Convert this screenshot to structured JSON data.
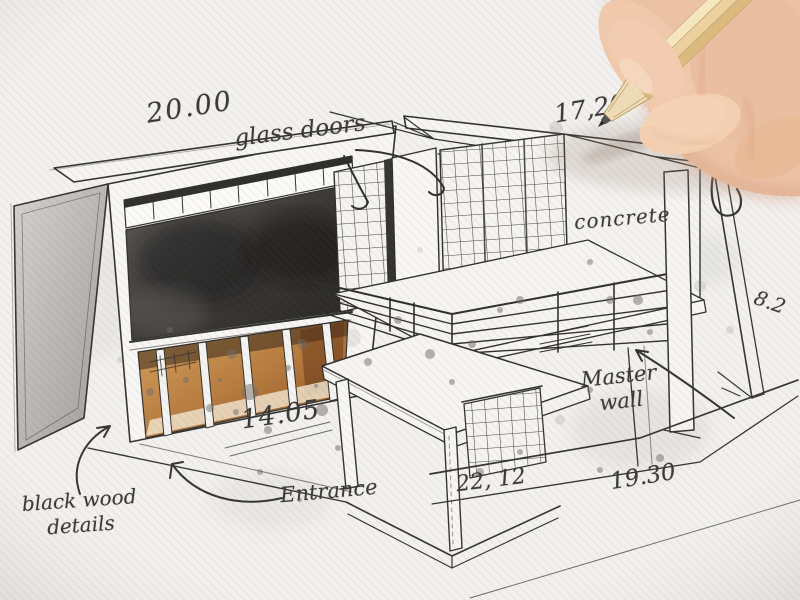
{
  "scene": {
    "title": "Architectural concept sketch of a modern house, drawn by hand with pencil",
    "paper_color": "#f3f1ef",
    "ink_color": "#2e2d2b",
    "dark_panel_color": "#33312f",
    "wood_interior_color": "#b97f3e",
    "skin_color": "#ecc2a6",
    "pencil_wood_color": "#ecd19e"
  },
  "annotations": {
    "dim_roof_left": "20.00",
    "glass_doors": "glass doors",
    "dim_roof_right": "17,20",
    "partial_letter": "s",
    "partial_word": "de",
    "concrete": "concrete",
    "dim_right_side": "8.2",
    "master_wall_line1": "Master",
    "master_wall_line2": "wall",
    "dim_ground": "14.05",
    "entrance": "Entrance",
    "dim_plinth": "22, 12",
    "dim_terrace": "19.30",
    "black_wood_line1": "black wood",
    "black_wood_line2": "details"
  }
}
